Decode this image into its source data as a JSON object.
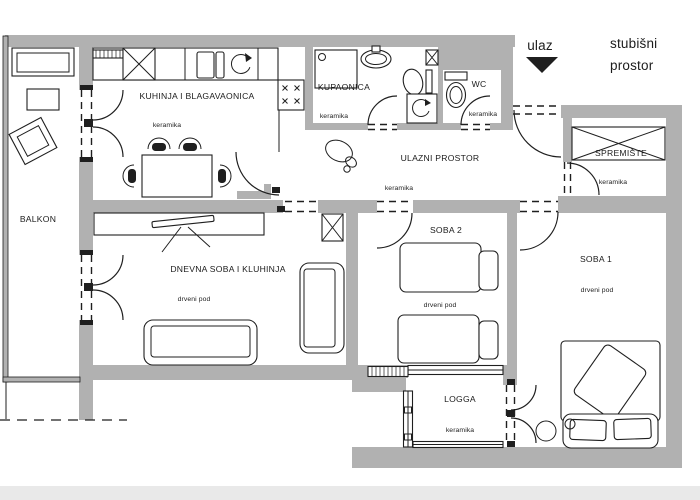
{
  "colors": {
    "wall": "#b1b1b1",
    "line": "#1f1f1f",
    "text": "#1c1c1c",
    "paper": "#ffffff",
    "edge": "#e9e9e9"
  },
  "outside": {
    "entrance_label": "ulaz",
    "stairwell_label_line1": "stubišni",
    "stairwell_label_line2": "prostor"
  },
  "rooms": {
    "balcony": {
      "name": "BALKON"
    },
    "kitchen_dining": {
      "name": "KUHINJA I BLAGAVAONICA",
      "floor": "keramika"
    },
    "bathroom": {
      "name": "KUPAONICA",
      "floor": "keramika"
    },
    "wc": {
      "name": "WC",
      "floor": "keramika"
    },
    "entry_hall": {
      "name": "ULAZNI PROSTOR",
      "floor": "keramika"
    },
    "storage": {
      "name": "SPREMIŠTE",
      "floor": "keramika"
    },
    "living_room": {
      "name": "DNEVNA SOBA I KLUHINJA",
      "floor": "drveni pod"
    },
    "bedroom2": {
      "name": "SOBA 2",
      "floor": "drveni pod"
    },
    "bedroom1": {
      "name": "SOBA 1",
      "floor": "drveni pod"
    },
    "loggia": {
      "name": "LOGGA",
      "floor": "keramika"
    }
  }
}
